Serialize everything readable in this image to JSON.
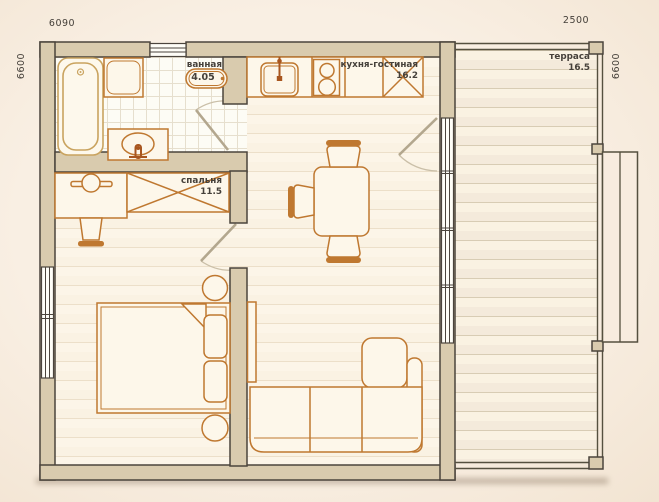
{
  "plan": {
    "type": "apartment-floor-plan",
    "dimensions": {
      "top": "6090",
      "terrace_top": "2500",
      "left": "6600",
      "right": "6600"
    },
    "rooms": {
      "bathroom": {
        "label": "ванная",
        "area": "4.05"
      },
      "kitchen_living": {
        "label": "кухня-гостиная",
        "area": "16.2"
      },
      "bedroom": {
        "label": "спальня",
        "area": "11.5"
      },
      "terrace": {
        "label": "терраса",
        "area": "16.5"
      }
    }
  },
  "colors": {
    "background": "#f8ecdf",
    "floor": "#fbf4e6",
    "wall_fill": "#d9cbae",
    "wall_outline": "#4b443c",
    "furniture_outline": "#bf7830",
    "bathtub_outline": "#c9a35f",
    "label_text": "#45403a"
  }
}
